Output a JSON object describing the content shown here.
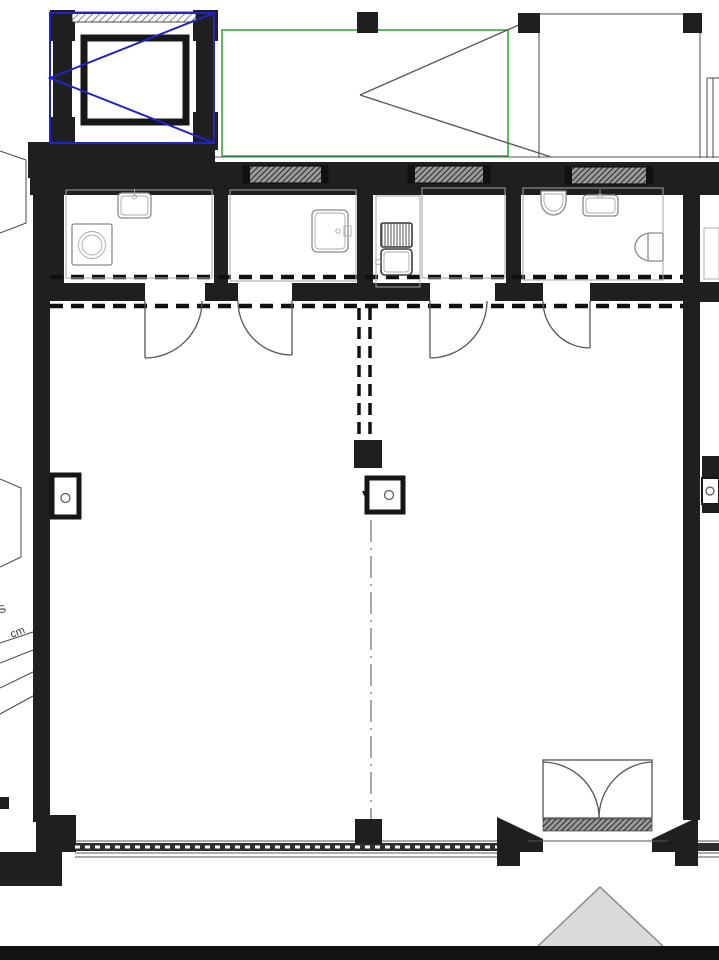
{
  "drawing": {
    "type": "architectural-floor-plan",
    "annotations": {
      "stair_label_line1": "S",
      "stair_label_line2": "cm"
    },
    "colors": {
      "wall": "#1f1f1f",
      "elevator_marker": "#2222cf",
      "area_marker": "#2fae3a",
      "swing_lines": "#5a5a5a",
      "dash": "#101010",
      "fixture_line": "#8a8a8a",
      "triangle_fill": "#dadada",
      "triangle_stroke": "#8c8c8c",
      "bottom_bar": "#121212"
    }
  }
}
